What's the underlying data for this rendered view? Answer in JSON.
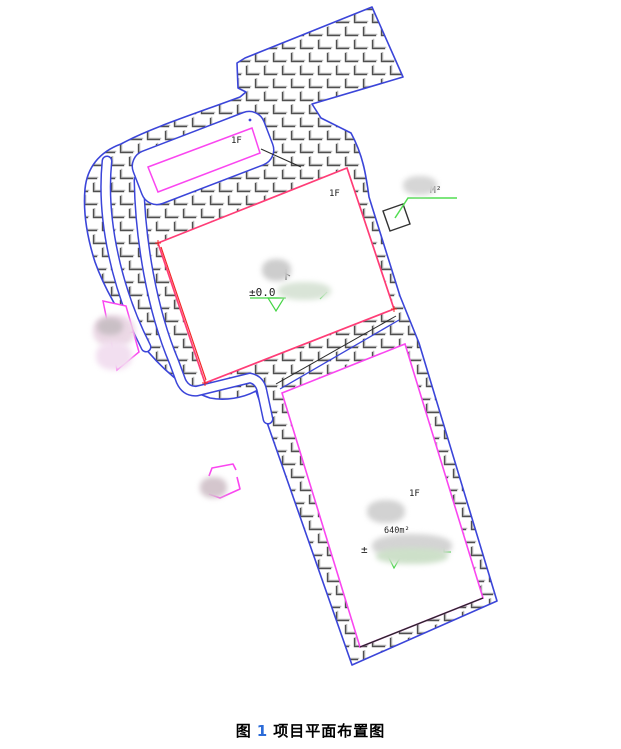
{
  "figure": {
    "caption": {
      "prefix": "图",
      "number": "1",
      "title": "项目平面布置图"
    }
  },
  "plan": {
    "floor_labels": {
      "annex": "1F",
      "building1": "1F",
      "building2": "1F"
    },
    "annotations": {
      "area_unit": "M²",
      "area_value": "640m²",
      "elevation_building1": "±0.0",
      "elevation_building2": "±"
    },
    "colors": {
      "boundary_blue": "#3b45d9",
      "building1_border": "#ff3d77",
      "building1_inner_red": "#f22929",
      "magenta": "#fa46f0",
      "annotation_green": "#44d544",
      "hatch_dark": "#4f4f4f",
      "hatch_light": "#bdbdbd",
      "line_black": "#2a2a2a",
      "caption_number_blue": "#2b6bd8"
    }
  }
}
